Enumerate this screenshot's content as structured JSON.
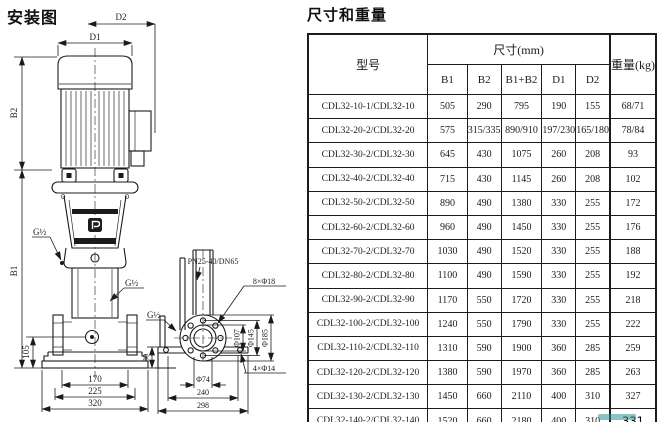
{
  "diagram": {
    "title": "安装图",
    "labels": {
      "d1": "D1",
      "d2": "D2",
      "b1": "B1",
      "b2": "B2",
      "n105": "105",
      "n170": "170",
      "n225": "225",
      "n320": "320",
      "g_upper": "G½",
      "g_lower": "G½",
      "g_side": "G½",
      "flange": "PN25-40/DN65",
      "holes8": "8×Φ18",
      "holes4": "4×Φ14",
      "d107": "Φ107",
      "d145": "Φ145",
      "d185": "Φ185",
      "d74": "Φ74",
      "n240": "240",
      "n298": "298",
      "n30": "30"
    }
  },
  "table": {
    "title": "尺寸和重量",
    "col_model": "型号",
    "col_size_group": "尺寸(mm)",
    "col_weight": "重量(kg)",
    "size_columns": [
      "B1",
      "B2",
      "B1+B2",
      "D1",
      "D2"
    ],
    "rows": [
      {
        "model": "CDL32-10-1/CDL32-10",
        "b1": "505",
        "b2": "290",
        "b1b2": "795",
        "d1": "190",
        "d2": "155",
        "weight": "68/71"
      },
      {
        "model": "CDL32-20-2/CDL32-20",
        "b1": "575",
        "b2": "315/335",
        "b1b2": "890/910",
        "d1": "197/230",
        "d2": "165/180",
        "weight": "78/84"
      },
      {
        "model": "CDL32-30-2/CDL32-30",
        "b1": "645",
        "b2": "430",
        "b1b2": "1075",
        "d1": "260",
        "d2": "208",
        "weight": "93"
      },
      {
        "model": "CDL32-40-2/CDL32-40",
        "b1": "715",
        "b2": "430",
        "b1b2": "1145",
        "d1": "260",
        "d2": "208",
        "weight": "102"
      },
      {
        "model": "CDL32-50-2/CDL32-50",
        "b1": "890",
        "b2": "490",
        "b1b2": "1380",
        "d1": "330",
        "d2": "255",
        "weight": "172"
      },
      {
        "model": "CDL32-60-2/CDL32-60",
        "b1": "960",
        "b2": "490",
        "b1b2": "1450",
        "d1": "330",
        "d2": "255",
        "weight": "176"
      },
      {
        "model": "CDL32-70-2/CDL32-70",
        "b1": "1030",
        "b2": "490",
        "b1b2": "1520",
        "d1": "330",
        "d2": "255",
        "weight": "188"
      },
      {
        "model": "CDL32-80-2/CDL32-80",
        "b1": "1100",
        "b2": "490",
        "b1b2": "1590",
        "d1": "330",
        "d2": "255",
        "weight": "192"
      },
      {
        "model": "CDL32-90-2/CDL32-90",
        "b1": "1170",
        "b2": "550",
        "b1b2": "1720",
        "d1": "330",
        "d2": "255",
        "weight": "218"
      },
      {
        "model": "CDL32-100-2/CDL32-100",
        "b1": "1240",
        "b2": "550",
        "b1b2": "1790",
        "d1": "330",
        "d2": "255",
        "weight": "222"
      },
      {
        "model": "CDL32-110-2/CDL32-110",
        "b1": "1310",
        "b2": "590",
        "b1b2": "1900",
        "d1": "360",
        "d2": "285",
        "weight": "259"
      },
      {
        "model": "CDL32-120-2/CDL32-120",
        "b1": "1380",
        "b2": "590",
        "b1b2": "1970",
        "d1": "360",
        "d2": "285",
        "weight": "263"
      },
      {
        "model": "CDL32-130-2/CDL32-130",
        "b1": "1450",
        "b2": "660",
        "b1b2": "2110",
        "d1": "400",
        "d2": "310",
        "weight": "327"
      },
      {
        "model": "CDL32-140-2/CDL32-140",
        "b1": "1520",
        "b2": "660",
        "b1b2": "2180",
        "d1": "400",
        "d2": "310",
        "weight": "331",
        "clean": true
      }
    ]
  }
}
